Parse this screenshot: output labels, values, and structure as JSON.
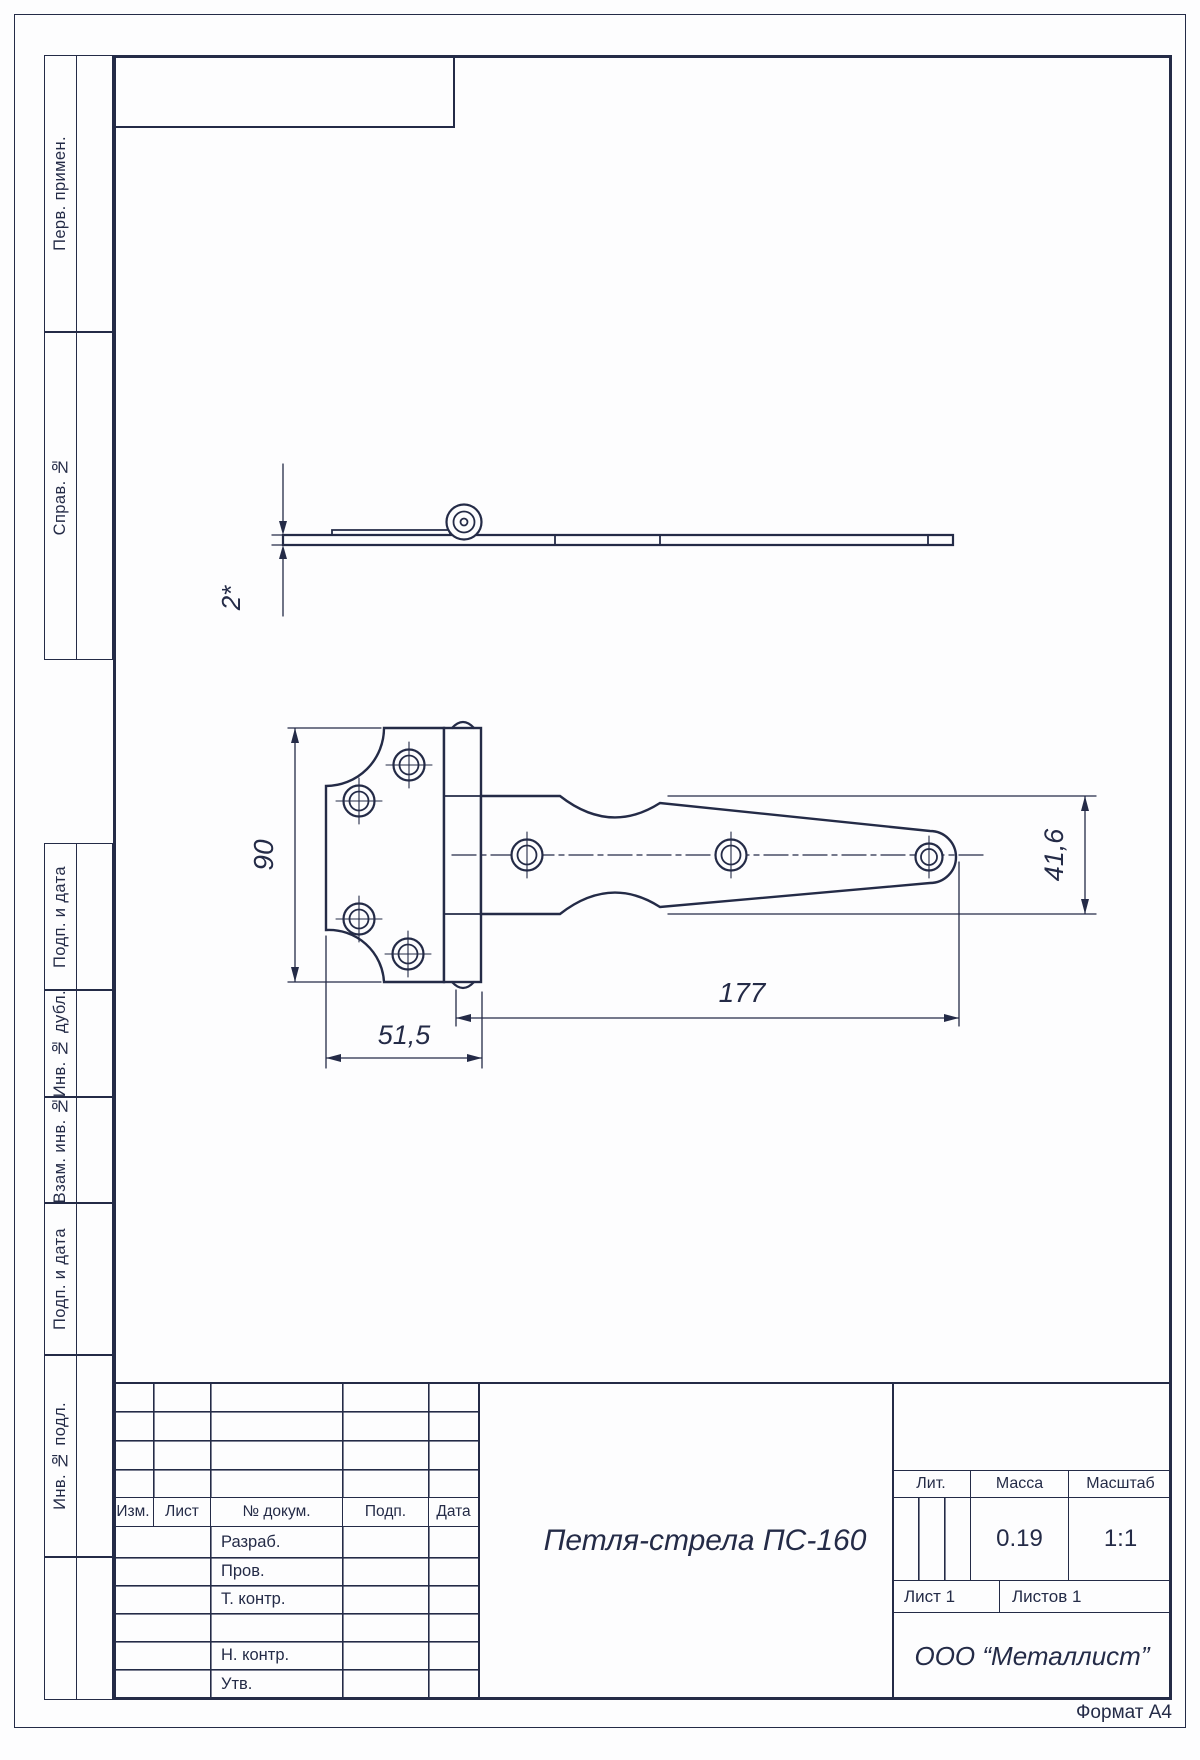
{
  "page": {
    "format_label": "Формат А4"
  },
  "sidebar": {
    "top_items": [
      {
        "label": "Перв. примен."
      },
      {
        "label": "Справ. №"
      }
    ],
    "bottom_items": [
      {
        "label": "Подп. и дата"
      },
      {
        "label": "Инв. № дубл."
      },
      {
        "label": "Взам. инв. №"
      },
      {
        "label": "Подп. и дата"
      },
      {
        "label": "Инв. № подл."
      },
      {
        "label": ""
      }
    ]
  },
  "title_block": {
    "revision_header": {
      "izm": "Изм.",
      "list": "Лист",
      "doc": "№ докум.",
      "podp": "Подп.",
      "data": "Дата"
    },
    "signature_rows": [
      "Разраб.",
      "Пров.",
      "Т. контр.",
      "",
      "Н. контр.",
      "Утв."
    ],
    "doc_title": "Петля-стрела ПС-160",
    "lit_label": "Лит.",
    "mass_label": "Масса",
    "scale_label": "Масштаб",
    "mass_value": "0.19",
    "scale_value": "1:1",
    "sheet_label": "Лист 1",
    "sheets_label": "Листов 1",
    "company": "ООО “Металлист”"
  },
  "drawing": {
    "dimensions": {
      "thickness": "2*",
      "plate_height": "90",
      "plate_width": "51,5",
      "strap_length": "177",
      "strap_width": "41,6"
    }
  }
}
